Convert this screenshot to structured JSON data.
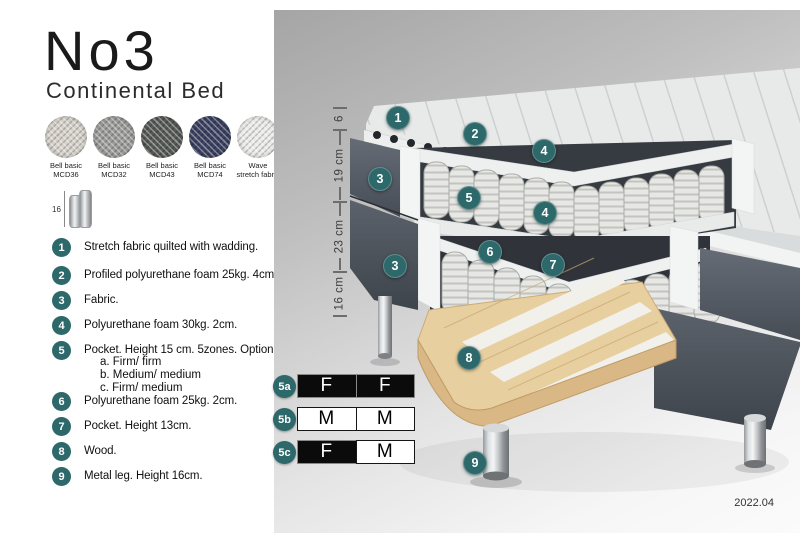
{
  "header": {
    "title": "No3",
    "subtitle": "Continental Bed"
  },
  "swatches": [
    {
      "name": "Bell basic",
      "code": "MCD36",
      "color": "#d6d2cb"
    },
    {
      "name": "Bell basic",
      "code": "MCD32",
      "color": "#9c9c9a"
    },
    {
      "name": "Bell basic",
      "code": "MCD43",
      "color": "#565a57"
    },
    {
      "name": "Bell basic",
      "code": "MCD74",
      "color": "#3b4161"
    },
    {
      "name": "Wave",
      "code": "stretch fabric",
      "color": "#ebebea"
    }
  ],
  "leg_icon": {
    "height_label": "16"
  },
  "legend": [
    {
      "num": "1",
      "text": "Stretch fabric quilted with wadding."
    },
    {
      "num": "2",
      "text": "Profiled polyurethane foam 25kg. 4cm."
    },
    {
      "num": "3",
      "text": "Fabric."
    },
    {
      "num": "4",
      "text": "Polyurethane foam 30kg. 2cm."
    },
    {
      "num": "5",
      "text": "Pocket. Height 15 cm. 5zones. Option:",
      "options": [
        "a. Firm/ firm",
        "b. Medium/ medium",
        "c. Firm/ medium"
      ]
    },
    {
      "num": "6",
      "text": "Polyurethane foam 25kg. 2cm."
    },
    {
      "num": "7",
      "text": "Pocket. Height 13cm."
    },
    {
      "num": "8",
      "text": "Wood."
    },
    {
      "num": "9",
      "text": "Metal leg. Height 16cm."
    }
  ],
  "dimensions": [
    "6",
    "19 cm",
    "23 cm",
    "16 cm"
  ],
  "callouts": [
    "1",
    "2",
    "3",
    "4",
    "5",
    "4",
    "6",
    "7",
    "3",
    "8",
    "9"
  ],
  "firmness_table": {
    "rows": [
      {
        "label": "5a",
        "cells": [
          {
            "text": "F",
            "style": "dark"
          },
          {
            "text": "F",
            "style": "dark"
          }
        ]
      },
      {
        "label": "5b",
        "cells": [
          {
            "text": "M",
            "style": "light"
          },
          {
            "text": "M",
            "style": "light"
          }
        ]
      },
      {
        "label": "5c",
        "cells": [
          {
            "text": "F",
            "style": "dark"
          },
          {
            "text": "M",
            "style": "light"
          }
        ]
      }
    ]
  },
  "footer": {
    "version": "2022.04"
  },
  "colors": {
    "accent_teal": "#2d686a",
    "fabric_dark": "#565c66",
    "wood": "#e8cf9f"
  }
}
